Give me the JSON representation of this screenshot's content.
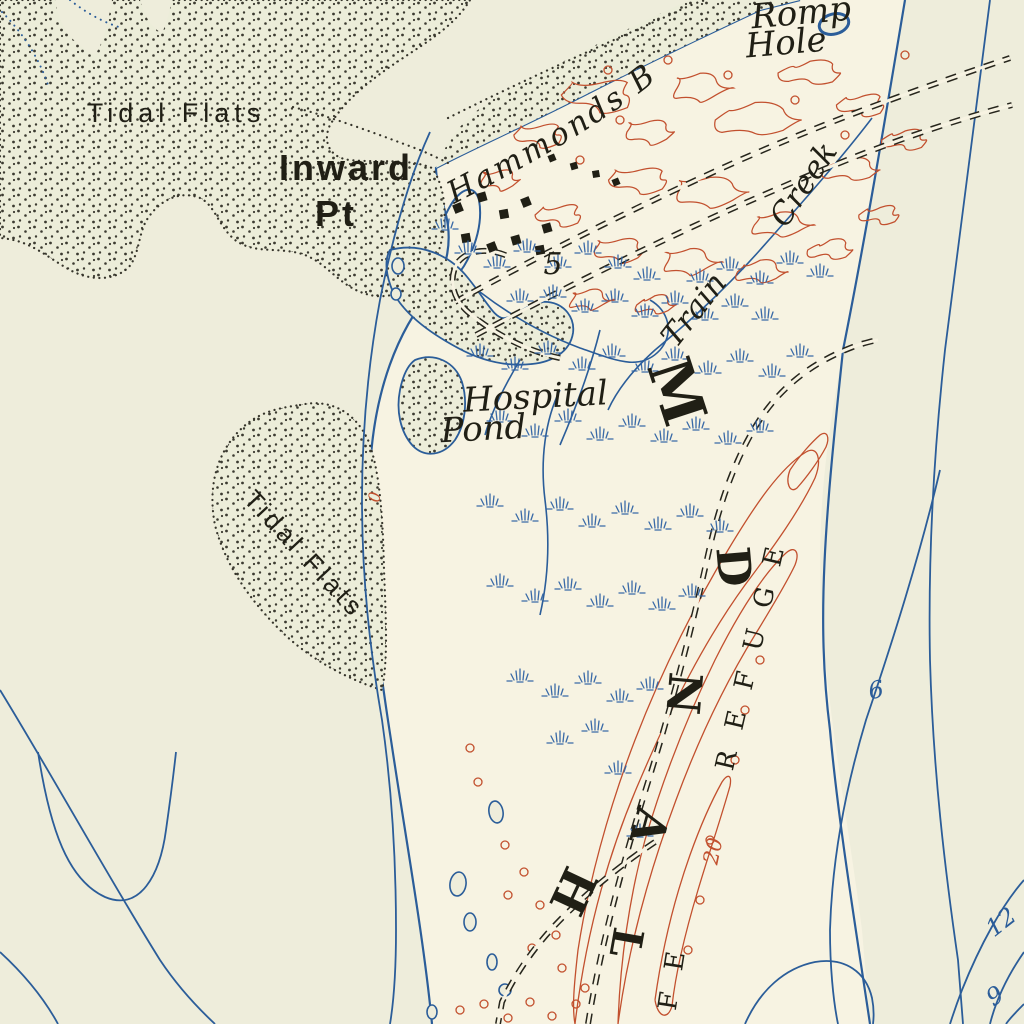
{
  "map": {
    "place_labels": {
      "tidal_flats_nw": "Tidal Flats",
      "tidal_flats_w": "Tidal Flats",
      "inward_point": {
        "line1": "Inward",
        "line2": "Pt"
      },
      "hammonds_bay": "Hammonds B",
      "romp_hole": {
        "line1": "Romp",
        "line2": "Hole"
      },
      "train_creek": {
        "word1": "Train",
        "word2": "Creek"
      },
      "hospital_pond": {
        "line1": "Hospital",
        "line2": "Pond"
      }
    },
    "island_spine_letters": [
      "M",
      "D",
      "N",
      "A",
      "H",
      "L"
    ],
    "refuge_label": "REFUGE",
    "refuge_label_continuation": "FE",
    "depth_soundings": {
      "five": "5",
      "six": "6",
      "nine": "9",
      "twelve": "12"
    },
    "contour_labels": {
      "twenty": "20",
      "zero": "0"
    },
    "colors": {
      "land": "#f7f3e2",
      "water": "#eeeddb",
      "flats_fill": "#ecedd9",
      "water_line_blue": "#2b5d99",
      "marsh_blue": "#2f62a3",
      "contour_red": "#c2502e",
      "ink_black": "#201f15"
    }
  }
}
